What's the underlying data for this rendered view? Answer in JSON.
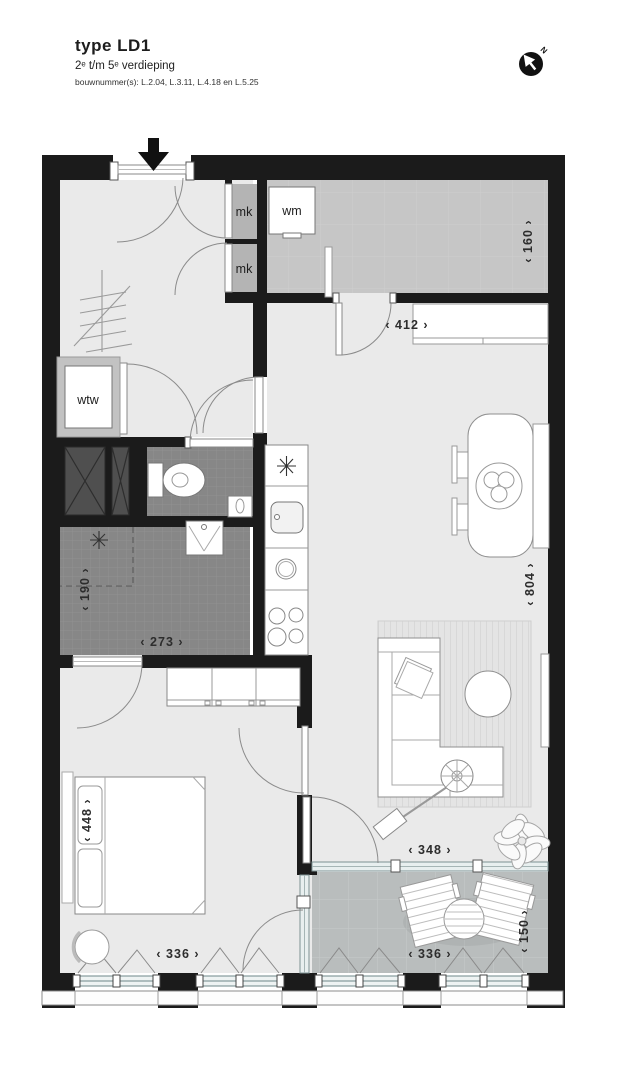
{
  "title_block": {
    "type_label": "type LD1",
    "floors_label": "2ᵉ t/m 5ᵉ verdieping",
    "bouwnummers_label": "bouwnummer(s): L.2.04, L.3.11, L.4.18 en L.5.25"
  },
  "compass": {
    "north_label": "N"
  },
  "room_labels": {
    "meter_closet_top": "mk",
    "meter_closet_bottom": "mk",
    "washing_machine": "wm",
    "heat_recovery_unit": "wtw"
  },
  "dimensions": {
    "storage_depth": "‹ 160 ›",
    "living_top_width": "‹ 412 ›",
    "living_length": "‹ 804 ›",
    "bathroom_width": "‹ 190 ›",
    "bathroom_length": "‹ 273 ›",
    "bed_length": "‹ 448 ›",
    "living_bottom_width": "‹ 348 ›",
    "bedroom_width": "‹ 336 ›",
    "balcony_width": "‹ 336 ›",
    "balcony_depth": "‹ 150 ›"
  },
  "colors": {
    "wall": "#1b1b1b",
    "floor_light": "#eaeaea",
    "floor_storage": "#c6c6c6",
    "floor_tile": "#878787",
    "floor_balcony": "#b9bdbd",
    "glass": "#e8efef"
  }
}
